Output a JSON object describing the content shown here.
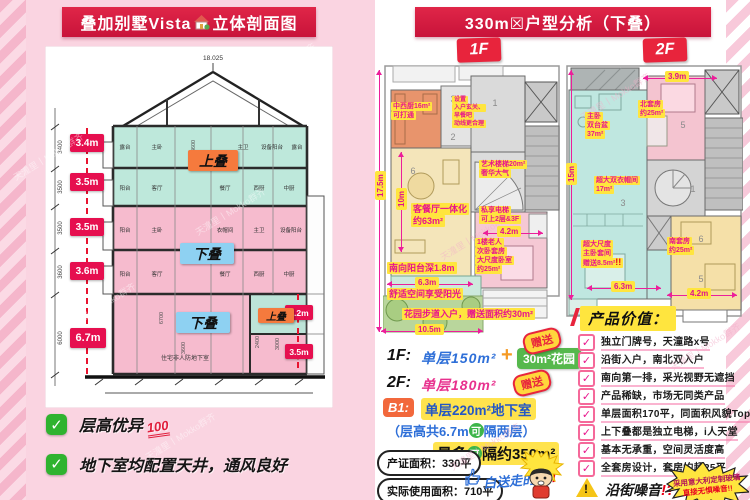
{
  "watermark": "天潼里丨Mokko群齐",
  "left": {
    "title_a": "叠加别墅Vista",
    "title_b": "立体剖面图",
    "roof_elev": "18.025",
    "dims": [
      "3.4m",
      "3.5m",
      "3.5m",
      "3.6m",
      "6.7m"
    ],
    "cad_vertical": [
      "3400",
      "3500",
      "3500",
      "3600",
      "6000"
    ],
    "cad_inner": [
      "3600",
      "6700",
      "3600",
      "2400",
      "3000"
    ],
    "side_dims": [
      "3.2m",
      "3.5m"
    ],
    "upper_label": "上叠",
    "lower_label": "下叠",
    "rooms_f4": [
      "露台",
      "主卧",
      "主卫",
      "设备阳台",
      "露台"
    ],
    "rooms_f3": [
      "阳台",
      "客厅",
      "餐厅",
      "西厨",
      "中厨"
    ],
    "rooms_f2": [
      "阳台",
      "主卧",
      "衣帽间",
      "主卫",
      "设备阳台"
    ],
    "rooms_f1": [
      "阳台",
      "客厅",
      "餐厅",
      "西厨",
      "中厨"
    ],
    "basement_label": "住宅非人防地下室",
    "check_glyph": "✓",
    "check1": "层高优异",
    "hundred": "100",
    "check2": "地下室均配置天井，通风良好"
  },
  "right": {
    "title": "330m☒户型分析（下叠）",
    "tab1": "1F",
    "tab2": "2F",
    "plan1": {
      "rooms": {
        "n4": "4",
        "n3": "3",
        "n1": "1",
        "n6": "6",
        "n2": "2"
      },
      "notes": {
        "kitchen": [
          "中西厨16m²",
          "可打通"
        ],
        "entry": [
          "设置",
          "入户玄关、",
          "早餐吧",
          "动线更合理"
        ],
        "stair": [
          "艺术楼梯20m²",
          "奢华大气"
        ],
        "lift": [
          "私享电梯",
          "可上2层&3F"
        ],
        "bedroom": [
          "1楼老人",
          "次卧套房",
          "大尺度卧室",
          "约25m²"
        ],
        "living": [
          "客餐厅一体化",
          "约63m²"
        ],
        "balcony": "南向阳台深1.8m",
        "sun": "舒适空间享受阳光",
        "garden": "花园步道入户，赠送面积约30m²"
      },
      "dims": {
        "total_h": "17.5m",
        "living_h": "10m",
        "bed_w": "4.2m",
        "balcony_w": "6.3m",
        "garden_w": "10.5m"
      }
    },
    "plan2": {
      "rooms": {
        "n5a": "5",
        "n3": "3",
        "n1": "1",
        "n6": "6",
        "n5b": "5"
      },
      "notes": {
        "mbath": [
          "主卧",
          "双台盆",
          "37m²"
        ],
        "north": [
          "北套房",
          "约25m²"
        ],
        "closet": [
          "超大双衣帽间",
          "17m²"
        ],
        "master": [
          "超大尺度",
          "主卧套间",
          "赠送8.5m²"
        ],
        "bang": "!!",
        "south": [
          "南套房",
          "约25m²"
        ]
      },
      "dims": {
        "top_w": "3.9m",
        "total_h": "15m",
        "left_w": "6.3m",
        "right_w": "4.2m"
      }
    },
    "info": {
      "f1_label": "1F:",
      "f1_value": "单层150m²",
      "plus": "+",
      "garden_pill": "30m²花园",
      "f2_label": "2F:",
      "f2_value": "单层180m²",
      "b1_label": "B1:",
      "b1_value": "单层220m²地下室",
      "gift": "赠送",
      "h_pre": "（层高共6.7m",
      "ke": "可",
      "h_post": "隔两层）",
      "max_pre": "最多",
      "max_post": "隔约350m²",
      "cert": "产证面积：330平",
      "actual": "实际使用面积：710平",
      "note": "白送走的:/",
      "note_bang": "!!"
    },
    "value": {
      "header": "产品价值：",
      "check_glyph": "✓",
      "points": [
        "独立门牌号，天潼路x号",
        "沿街入户，南北双入户",
        "南向第一排，采光视野无遮挡",
        "产品稀缺，市场无同类产品",
        "单层面积170平，同面积风貌Top",
        "上下叠都是独立电梯，i人天堂",
        "基本无承重，空间灵活度高",
        "全套房设计，套房均超25平"
      ],
      "warning": "沿街噪音",
      "warning_marks": "!?",
      "warn_glyph": "!",
      "burst_l1": "采用意大利定制玻璃",
      "burst_l2": "直接无惧噪音!!"
    }
  }
}
